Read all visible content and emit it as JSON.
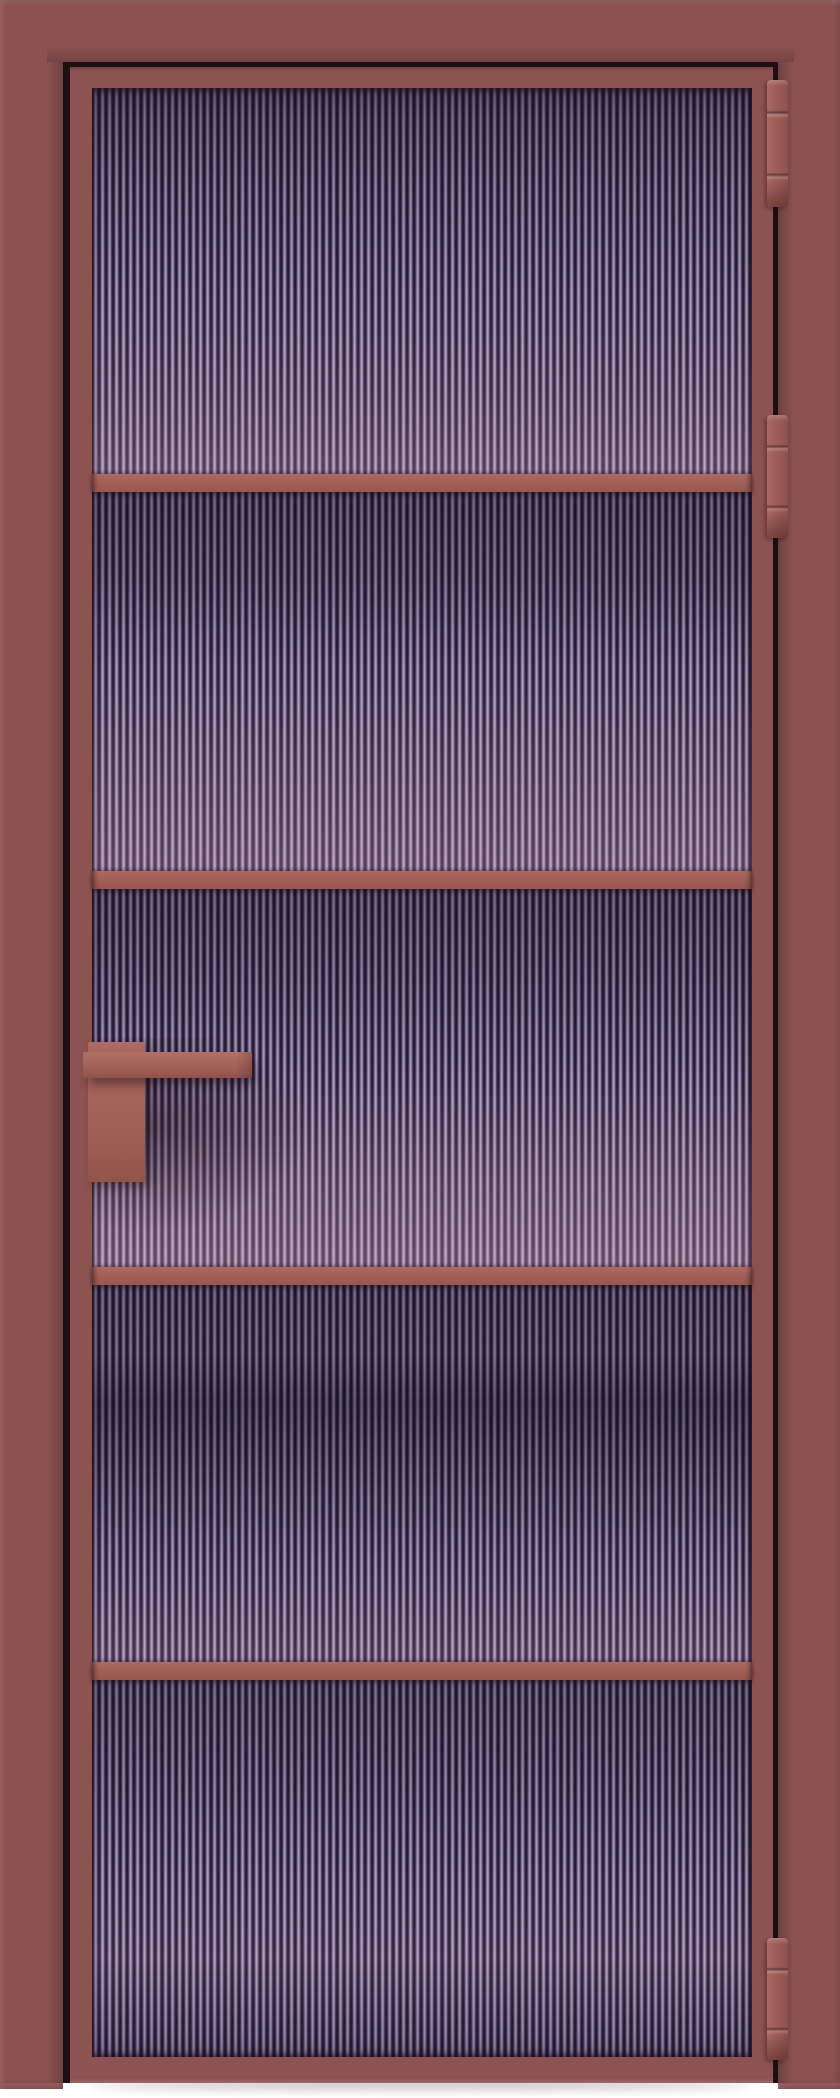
{
  "scene": {
    "type": "product-photo",
    "subject": "interior glass door, closed, front view",
    "description": "Terracotta red aluminium-framed interior door with purple-tinted fluted (reeded) glass split into five sections by four horizontal glazing bars; flat lever handle on the left stile; three barrel hinges on the right edge; white floor strip at the bottom",
    "background_color": "#ffffff",
    "visible_text": ""
  },
  "door": {
    "frame_finish": "terracotta red matte",
    "glass_style": "fluted reeded glass, lilac-purple tint",
    "glass_sections": 5,
    "glazing_bars": 4,
    "hinge_count": 3,
    "hinge_side": "right",
    "handle_side": "left"
  },
  "colors": {
    "casing": "#8b5151",
    "leaf": "#8d5351",
    "gap_shadow": "#1e0f12",
    "divider": "#a25f58",
    "hinge": "#9d5d57",
    "handle": "#a8655d",
    "glass_dark": "#221a30",
    "glass_mid": "#83739a",
    "glass_light": "#b4a5c4",
    "glass_pink_cast": "#d7a2b2",
    "floor": "#ffffff"
  },
  "geometry": {
    "canvas": {
      "width": 840,
      "height": 2098
    },
    "casing": {
      "left": 0,
      "top": 0,
      "width": 840,
      "height": 2083
    },
    "rebate": {
      "left": 63,
      "top": 62,
      "width": 715,
      "height": 2021
    },
    "leaf": {
      "left": 70,
      "top": 67,
      "width": 703,
      "height": 2016
    },
    "glass": {
      "left": 92,
      "top": 88,
      "width": 660,
      "height": 1969
    },
    "divider_height": 18,
    "dividers": [
      {
        "top": 474
      },
      {
        "top": 871
      },
      {
        "top": 1267
      },
      {
        "top": 1662
      }
    ],
    "hinge": {
      "left": 767,
      "width": 21
    },
    "hinges": [
      {
        "top": 80,
        "height": 127
      },
      {
        "top": 415,
        "height": 123
      },
      {
        "top": 1938,
        "height": 122
      }
    ],
    "handle": {
      "plate": {
        "left": 88,
        "top": 1042,
        "width": 57,
        "height": 140
      },
      "lever": {
        "left": 83,
        "top": 1052,
        "width": 169,
        "height": 26
      }
    },
    "left_foot": {
      "left": 0,
      "top": 2083,
      "width": 63,
      "height": 6
    },
    "right_foot": {
      "left": 778,
      "top": 2083,
      "width": 62,
      "height": 6
    },
    "floor": {
      "left": 0,
      "top": 2083,
      "width": 840,
      "height": 15
    },
    "door_shadow": {
      "left": 90,
      "top": 2081,
      "width": 660,
      "height": 8
    }
  }
}
